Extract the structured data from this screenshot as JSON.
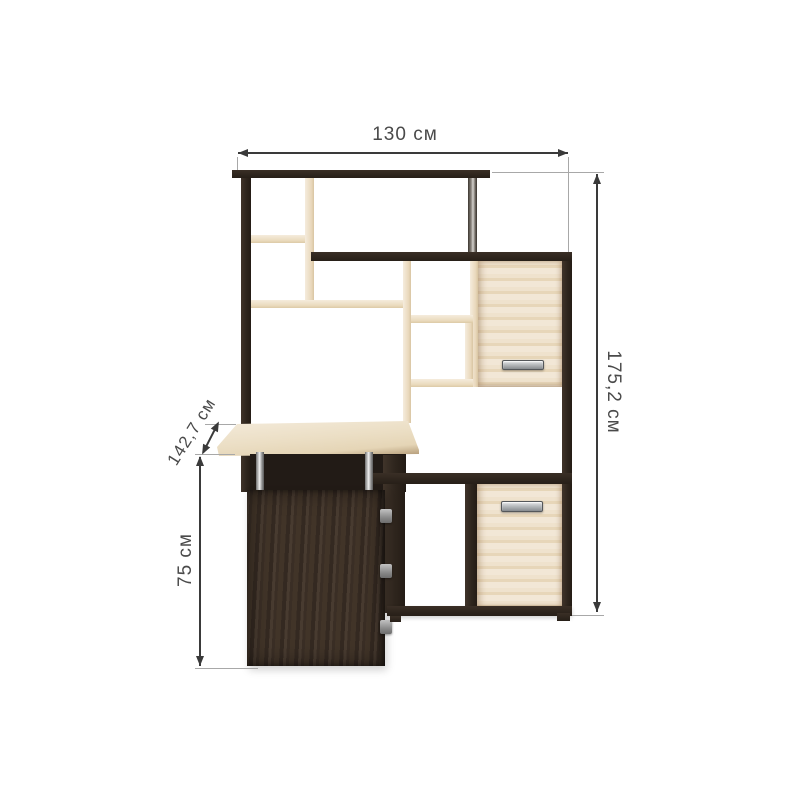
{
  "image": {
    "description": "Corner computer desk with tall shelving unit, product dimension diagram",
    "background": "#ffffff"
  },
  "dimensions": {
    "width": {
      "value": "130",
      "unit": "см",
      "label": "130 см"
    },
    "height": {
      "value": "175,2",
      "unit": "см",
      "label": "175,2 см"
    },
    "depth": {
      "value": "142,7",
      "unit": "см",
      "label": "142,7 см"
    },
    "desk_height": {
      "value": "75",
      "unit": "см",
      "label": "75 см"
    }
  },
  "materials": {
    "dark_wood": "#30271f",
    "pedestal_wood": "#41342a",
    "light_wood": "#ecdec6",
    "desk_surface": "#ebdec4",
    "chrome": "#c9c9c9",
    "handle": "#a7abae",
    "dimension_line": "#3a3a3a",
    "extension_line": "#a8a8a8",
    "label_text": "#4a4a4a"
  }
}
